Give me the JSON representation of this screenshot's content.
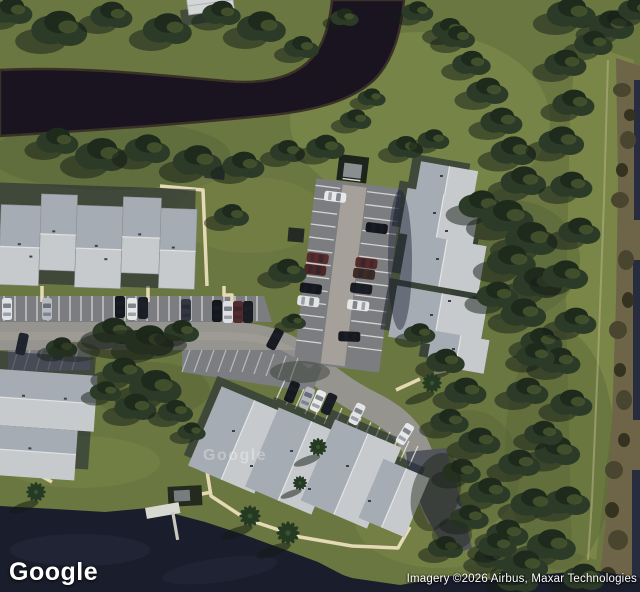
{
  "view": {
    "type": "satellite",
    "description": "Aerial satellite view of a condominium complex: gray gabled roofs, parking lots with cars, lawns, dense tree lines, a dark canal across the top and a pond at the bottom left."
  },
  "watermarks": {
    "logo": "Google",
    "tile_overlay": "Google"
  },
  "attribution": {
    "text": "Imagery ©2026 Airbus, Maxar Technologies"
  },
  "palette": {
    "grass": "#6B7740",
    "grass_light": "#7B8849",
    "grass_dark": "#566338",
    "canal": "#191420",
    "lake": "#1A1E2C",
    "tree": "#2C3B27",
    "tree_dark": "#1D2A1C",
    "shadow": "#1B2233",
    "roof_light": "#C7CACD",
    "roof_mid": "#A6ACB3",
    "road": "#96948E",
    "lot": "#7C7D80",
    "aisle": "#A5A19A",
    "walk": "#EBDFBC",
    "line": "#E8E8E6",
    "scrub": "#6E6549",
    "water_edge": "#272C3E"
  }
}
